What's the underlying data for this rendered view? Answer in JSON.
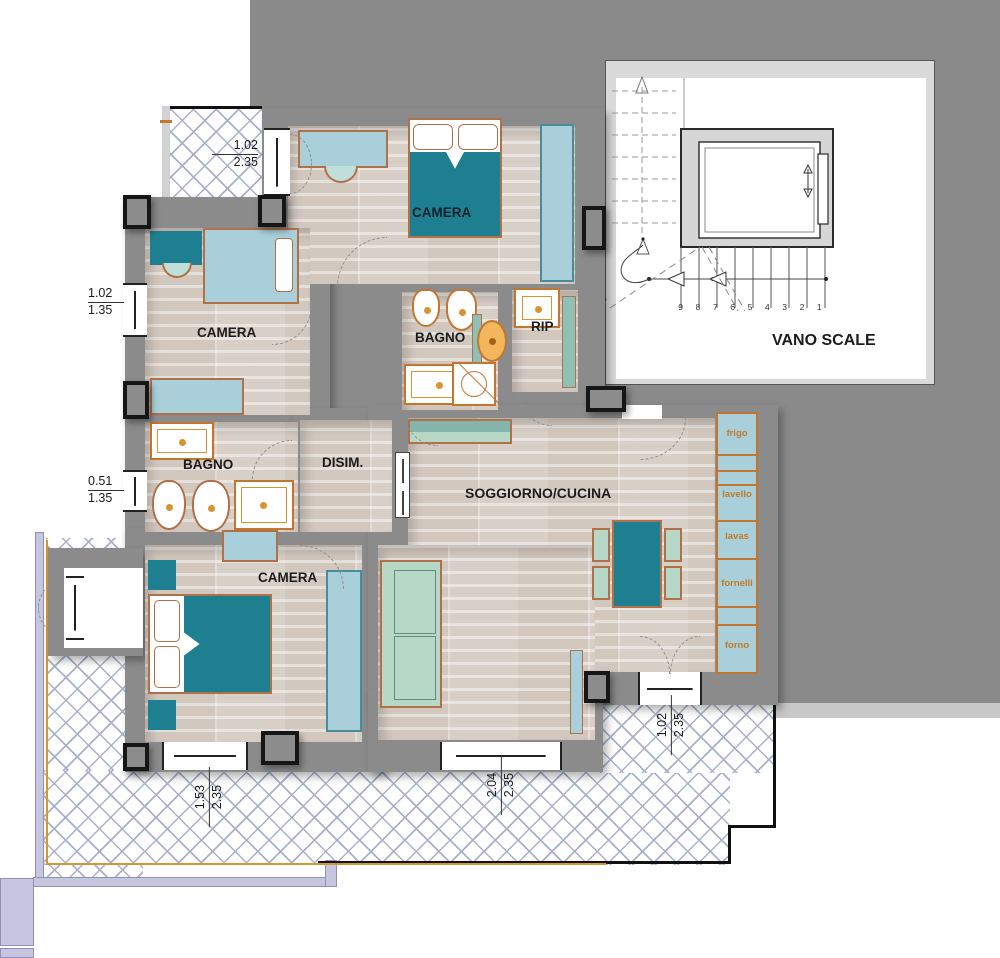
{
  "plan": {
    "rooms": {
      "camera_top": "CAMERA",
      "camera_left": "CAMERA",
      "camera_bottom": "CAMERA",
      "bagno_top": "BAGNO",
      "bagno_left": "BAGNO",
      "rip": "RIP",
      "disim": "DISIM.",
      "soggiorno": "SOGGIORNO/CUCINA",
      "vano_scale": "VANO SCALE"
    },
    "kitchen_units": [
      "frigo",
      "lavello",
      "lavas",
      "fornelli",
      "forno"
    ],
    "dimensions": {
      "balcony_door_top": {
        "w": "1.02",
        "h": "2.35"
      },
      "window_camera_left": {
        "w": "1.02",
        "h": "1.35"
      },
      "window_bagno_left": {
        "w": "0.51",
        "h": "1.35"
      },
      "window_camera_bottom": {
        "w": "1.53",
        "h": "2.35"
      },
      "window_soggiorno_bottom": {
        "w": "2.04",
        "h": "2.35"
      },
      "door_soggiorno_terrace": {
        "w": "1.02",
        "h": "2.35"
      }
    },
    "stairs": {
      "treads": [
        "9",
        "8",
        "7",
        "6",
        "5",
        "4",
        "3",
        "2",
        "1"
      ],
      "landing": "10"
    },
    "colors": {
      "outside_gray": "#8a8a8a",
      "wall_gray": "#8b8b8b",
      "floor": "#d8cfc7",
      "teal_furniture": "#1e7f90",
      "light_blue_furniture": "#a9cfdb",
      "pale_green_furniture": "#b7d8c6",
      "fixture_orange": "#c4762e",
      "hatch_line": "#a9b0cd",
      "parapet_lavender": "#c6c6e0"
    }
  }
}
